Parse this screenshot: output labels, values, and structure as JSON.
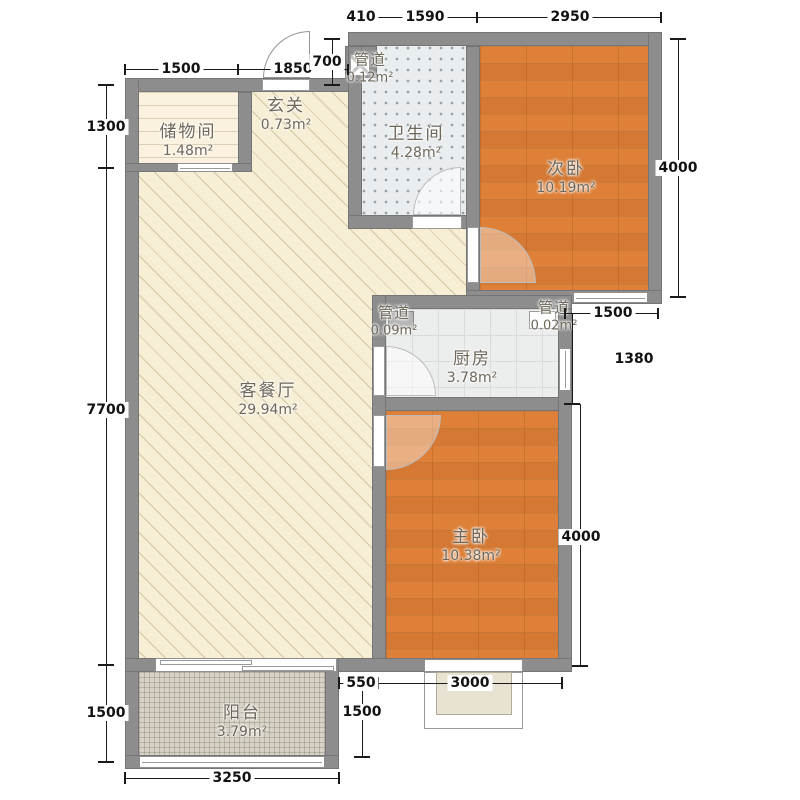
{
  "plan_type": "apartment-floor-plan",
  "rooms": {
    "storage": {
      "name": "储物间",
      "area": "1.48m²"
    },
    "hallway": {
      "name": "玄关",
      "area": "0.73m²"
    },
    "duct_top": {
      "name": "管道",
      "area": "0.12m²"
    },
    "bathroom": {
      "name": "卫生间",
      "area": "4.28m²"
    },
    "bedroom2": {
      "name": "次卧",
      "area": "10.19m²"
    },
    "duct_kitchen_left": {
      "name": "管道",
      "area": "0.09m²"
    },
    "duct_kitchen_right": {
      "name": "管道",
      "area": "0.02m²"
    },
    "kitchen": {
      "name": "厨房",
      "area": "3.78m²"
    },
    "living": {
      "name": "客餐厅",
      "area": "29.94m²"
    },
    "master": {
      "name": "主卧",
      "area": "10.38m²"
    },
    "balcony": {
      "name": "阳台",
      "area": "3.79m²"
    }
  },
  "dimensions": {
    "top_row": [
      "410",
      "1590",
      "2950"
    ],
    "second_row": [
      "1500",
      "1850"
    ],
    "offset_700": "700",
    "left": [
      "1300",
      "7700",
      "1500"
    ],
    "right_bedroom2": "4000",
    "right_1500": "1500",
    "right_1380": "1380",
    "right_master": "4000",
    "bottom_550": "550",
    "bottom_3000": "3000",
    "bottom_right_1500": "1500",
    "bottom_3250": "3250"
  },
  "colors": {
    "wall": "#8d8d8d",
    "living_floor": "#f6eed5",
    "wood_floor": "#de8038",
    "bath_floor": "#e9edef",
    "kitchen_floor": "#eceeed",
    "balcony_floor": "#d7d2c5",
    "storage_floor": "#faf2de",
    "dim_text": "#121212"
  }
}
